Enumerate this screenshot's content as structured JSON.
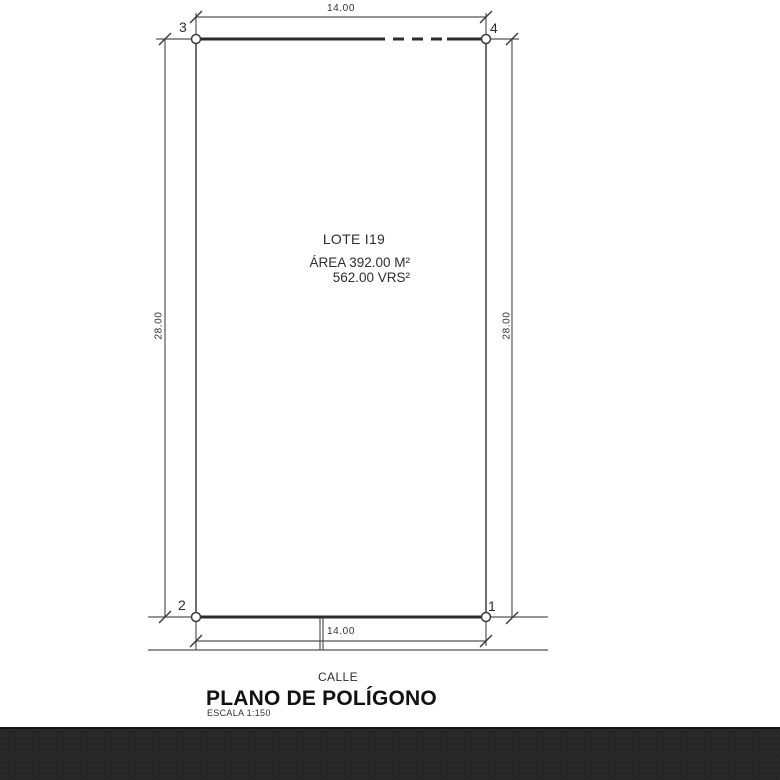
{
  "plan": {
    "corner_labels": {
      "top_left": "3",
      "top_right": "4",
      "bottom_left": "2",
      "bottom_right": "1"
    },
    "dims": {
      "top": "14.00",
      "bottom": "14.00",
      "left": "28.00",
      "right": "28.00"
    },
    "lot": {
      "name": "LOTE I19",
      "area_m2": "ÁREA 392.00 M²",
      "area_vrs": "562.00 VRS²"
    },
    "street_label": "CALLE",
    "title": "PLANO DE POLÍGONO",
    "scale_label": "ESCALA 1:150",
    "colors": {
      "edge": "#2b2b2b",
      "line": "#555555",
      "text": "#222222",
      "footer_bar": "#282828"
    }
  }
}
